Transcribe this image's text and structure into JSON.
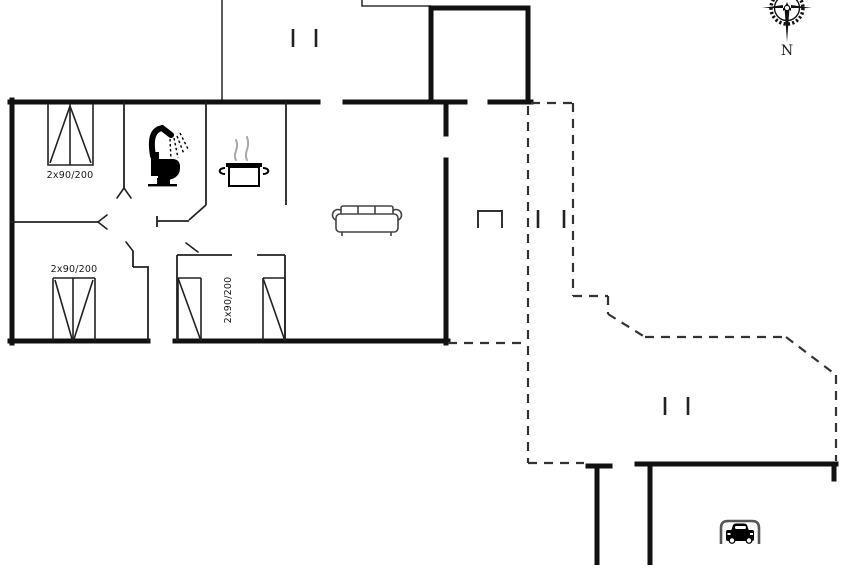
{
  "plan": {
    "title": "holiday-home-floorplan",
    "labels": {
      "bed_top_left": "2x90/200",
      "bed_bottom_left": "2x90/200",
      "bed_bottom_middle": "2x90/200",
      "compass_north": "N"
    },
    "icons": [
      "compass-rose-icon",
      "shower-icon",
      "toilet-icon",
      "cooking-pot-icon",
      "sofa-icon",
      "car-icon"
    ],
    "colors": {
      "wall": "#111111",
      "thin_wall": "#222222",
      "dashed_line": "#333333",
      "background": "#ffffff",
      "steam_gray": "#a8a8a8",
      "icon_gray": "#555555"
    }
  }
}
